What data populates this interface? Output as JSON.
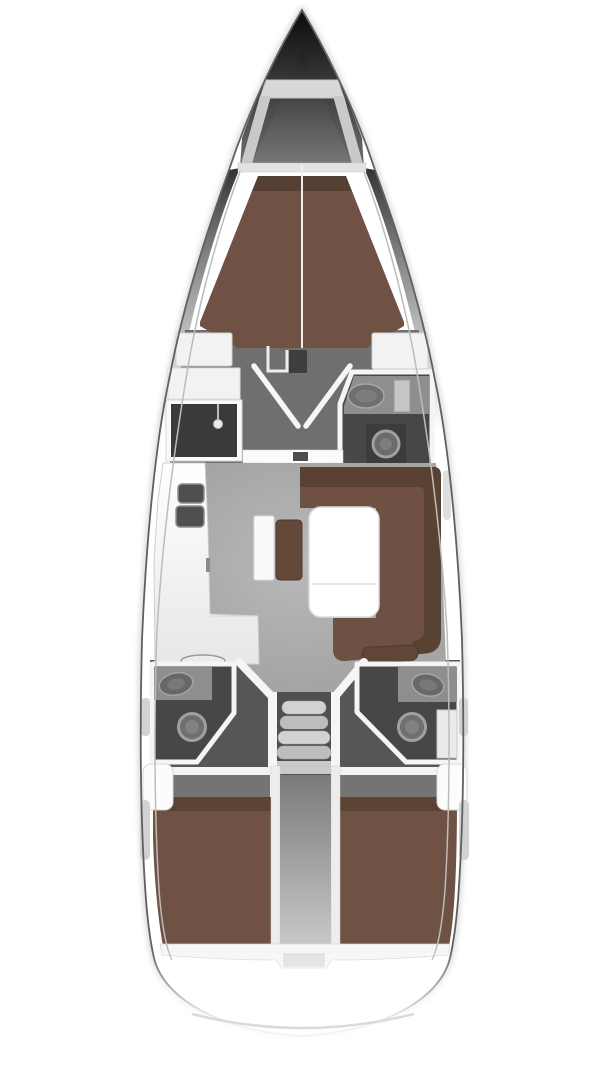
{
  "diagram": {
    "type": "floor-plan",
    "subject": "sailing-yacht-interior-top-view",
    "areas": [
      "bow",
      "anchor-locker",
      "forward-cabin-berth",
      "cabin-lobby",
      "wardrobe",
      "forward-head",
      "saloon",
      "galley",
      "sideboard",
      "stool",
      "dining-table",
      "u-settee",
      "companionway-steps",
      "aft-head-port",
      "aft-head-starboard",
      "aft-cabin-port",
      "aft-cabin-starboard",
      "engine-compartment",
      "stern"
    ]
  },
  "colors": {
    "background": "#ffffff",
    "hull_line": "#606060",
    "hull_soft": "#9a9a9a",
    "deck_line": "#bcbcbc",
    "bow_tip": "#0b0b0b",
    "bow_base": "#6e6e6e",
    "locker_top": "#1f1f1f",
    "locker_bottom": "#787878",
    "platform": "#d8d8d8",
    "rail": "#c9c9c9",
    "foredeck_band": "#e2e2e2",
    "berth_brown": "#6f5243",
    "settee_brown": "#6e5142",
    "settee_back": "#5a4233",
    "cushion_brown": "#5f4636",
    "stool_brown": "#64493a",
    "lobby_floor": "#6f6f6f",
    "salon_floor": "#a5a5a5",
    "dark_floor": "#565656",
    "head_floor": "#474747",
    "wardrobe_dark": "#3a3a3a",
    "counter_gray": "#8e8e8e",
    "sink_dark": "#4f4f4f",
    "fixture_gray": "#6f6f6f",
    "fixture_ring": "#a0a0a0",
    "cabinet_gray": "#c6c6c6",
    "step_light": "#d2d2d2",
    "step_mid": "#bdbdbd",
    "landing": "#c9c9c9",
    "engine_top": "#7a7a7a",
    "engine_bottom": "#c9c9c9",
    "headboard_gray": "#747474",
    "wall_white": "#f5f5f5",
    "furniture_white": "#f2f2f2",
    "band_white": "#f6f6f6",
    "notch_gray": "#e0e0e0",
    "stern_arc": "#dadada",
    "accent_gray": "#d2d2d2",
    "table_white": "#ffffff"
  }
}
